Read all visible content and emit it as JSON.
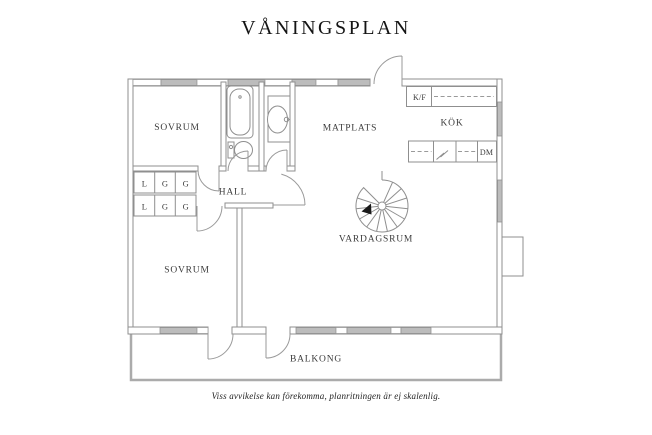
{
  "page": {
    "title": "VÅNINGSPLAN",
    "footer": "Viss avvikelse kan förekomma, planritningen är ej skalenlig."
  },
  "rooms": {
    "sovrum_top": "SOVRUM",
    "sovrum_bottom": "SOVRUM",
    "hall": "HALL",
    "matplats": "MATPLATS",
    "kok": "KÖK",
    "vardagsrum": "VARDAGSRUM",
    "balkong": "BALKONG"
  },
  "appliances": {
    "fridge_freezer": "K/F",
    "dishwasher": "DM"
  },
  "closets": {
    "row1": [
      "L",
      "G",
      "G"
    ],
    "row2": [
      "L",
      "G",
      "G"
    ]
  },
  "colors": {
    "wall_line": "#8f8f8f",
    "window_fill": "#bcbcbc",
    "door_line": "#9a9a9a",
    "balcony_line": "#ababab",
    "label_text": "#3b3b3b",
    "title_text": "#141414"
  }
}
